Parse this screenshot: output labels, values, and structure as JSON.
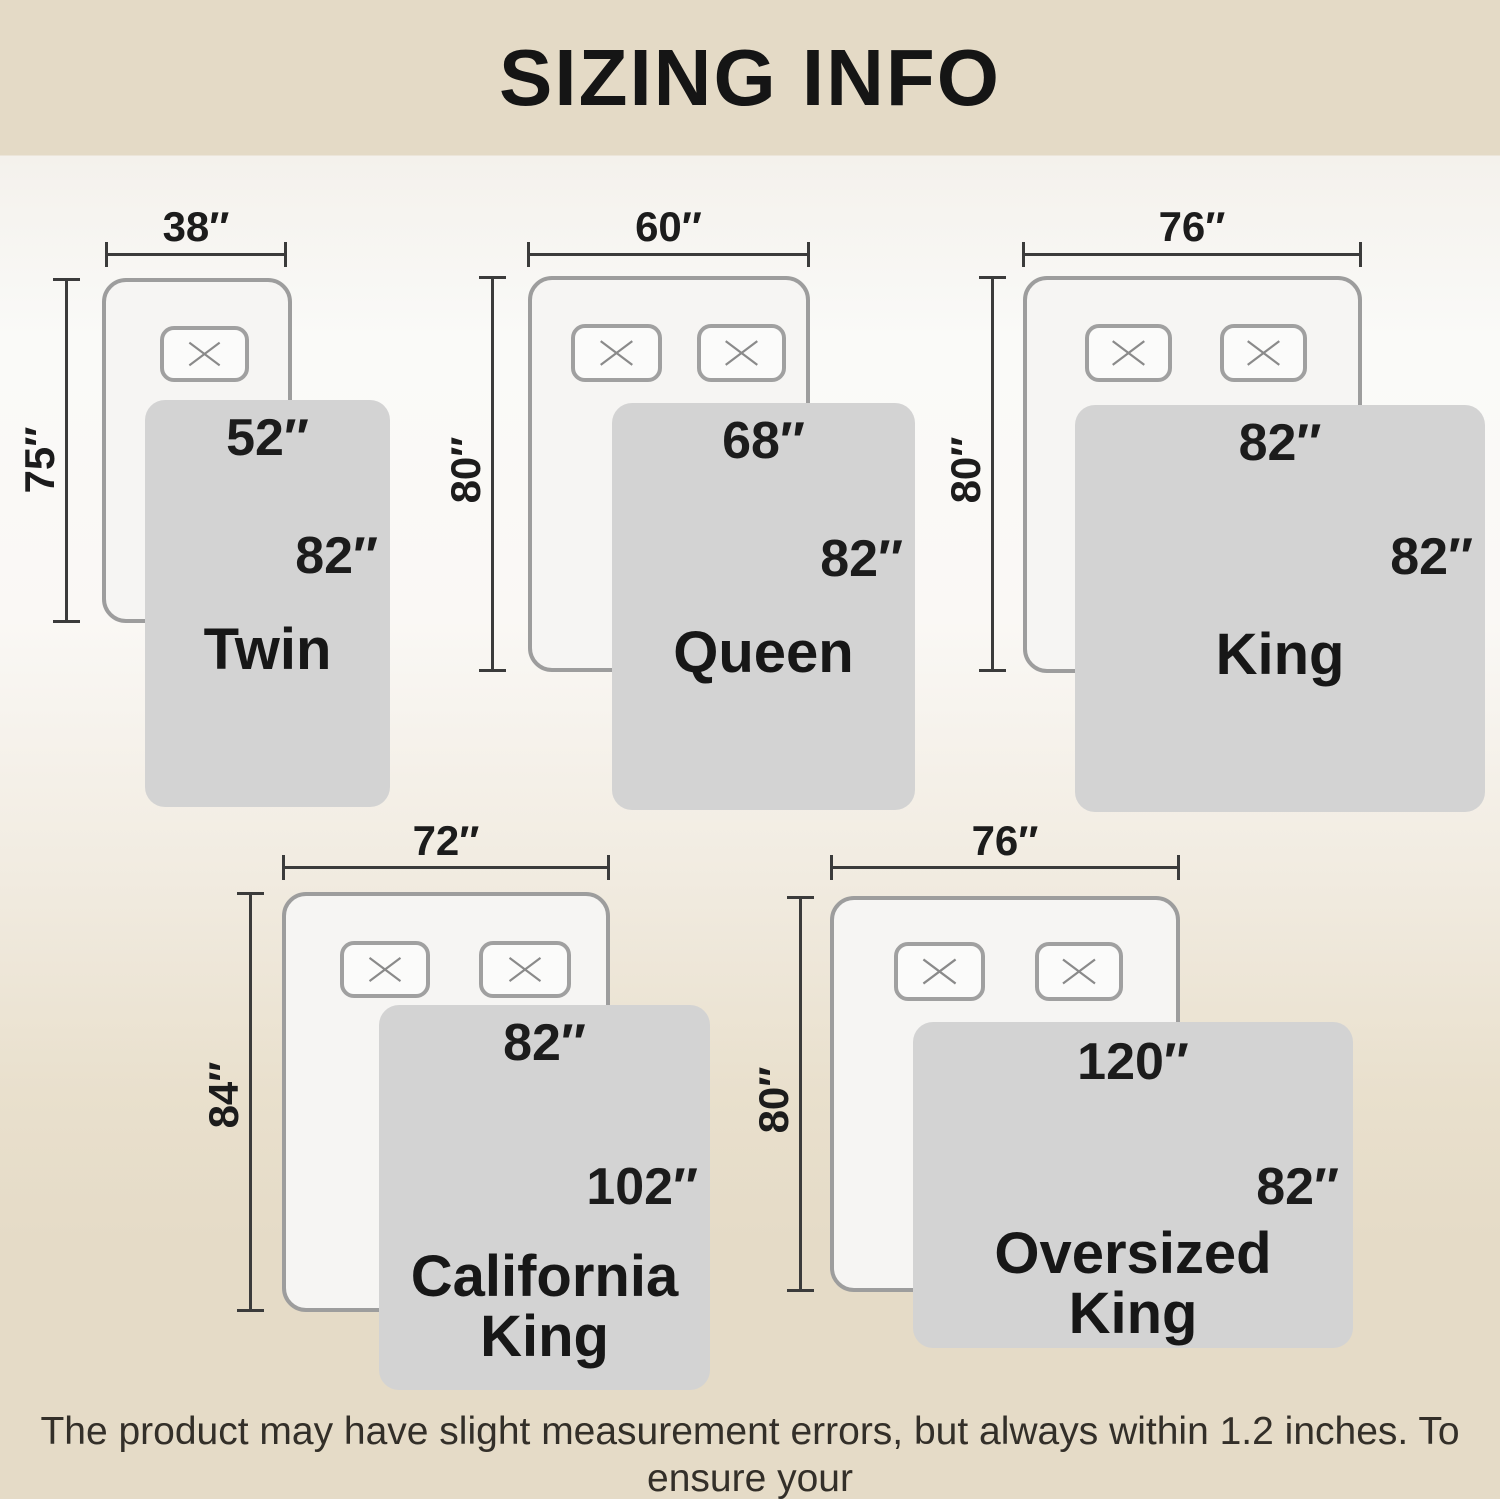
{
  "title": "SIZING INFO",
  "footer": {
    "line1": "The product may have slight measurement errors, but always within 1.2 inches. To ensure your",
    "line2": "satisfaction, consider ordering a larger size to cover more area."
  },
  "colors": {
    "band_beige": "#e4dac6",
    "blanket_gray": "#d3d3d3",
    "bed_fill": "#f6f5f3",
    "outline_gray": "#9d9d9d",
    "text_black": "#1c1c1c"
  },
  "beds": [
    {
      "name": "Twin",
      "mattress_width": "38″",
      "mattress_length": "75″",
      "blanket_width": "52″",
      "blanket_length": "82″"
    },
    {
      "name": "Queen",
      "mattress_width": "60″",
      "mattress_length": "80″",
      "blanket_width": "68″",
      "blanket_length": "82″"
    },
    {
      "name": "King",
      "mattress_width": "76″",
      "mattress_length": "80″",
      "blanket_width": "82″",
      "blanket_length": "82″"
    },
    {
      "name": "California King",
      "mattress_width": "72″",
      "mattress_length": "84″",
      "blanket_width": "82″",
      "blanket_length": "102″"
    },
    {
      "name": "Oversized King",
      "mattress_width": "76″",
      "mattress_length": "80″",
      "blanket_width": "120″",
      "blanket_length": "82″"
    }
  ]
}
